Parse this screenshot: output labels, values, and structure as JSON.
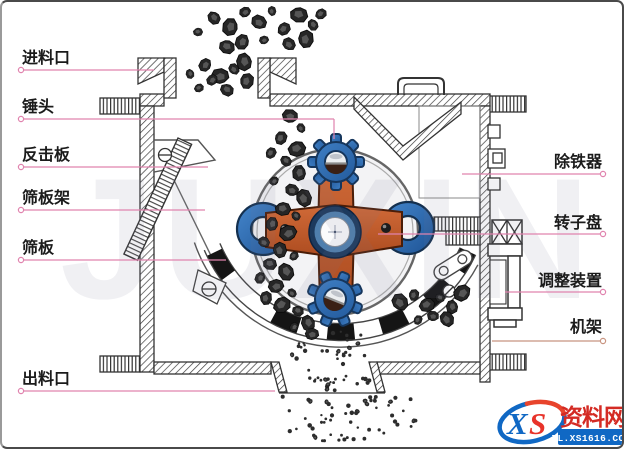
{
  "diagram": {
    "type": "hammer-crusher-structure-diagram",
    "labels_left": [
      {
        "id": "feed-inlet",
        "text": "进料口"
      },
      {
        "id": "hammer-head",
        "text": "锤头"
      },
      {
        "id": "impact-plate",
        "text": "反击板"
      },
      {
        "id": "screen-frame",
        "text": "筛板架"
      },
      {
        "id": "screen-plate",
        "text": "筛板"
      },
      {
        "id": "discharge-outlet",
        "text": "出料口"
      }
    ],
    "labels_right": [
      {
        "id": "iron-remover",
        "text": "除铁器"
      },
      {
        "id": "rotor-disc",
        "text": "转子盘"
      },
      {
        "id": "adjusting-device",
        "text": "调整装置"
      },
      {
        "id": "frame",
        "text": "机架"
      }
    ],
    "colors": {
      "leader_line": "#e083ae",
      "frame_leader_line": "#c89480",
      "rotor_orange": "#c2582a",
      "hammer_blue": "#2f6db5",
      "disc_gray": "#f3f3f5",
      "screen_black": "#151515"
    }
  },
  "watermark": {
    "text": "JUXIN"
  },
  "logo": {
    "monogram": {
      "x": "X",
      "s": "S"
    },
    "site_name": "资料网",
    "domain": "ZL.XS1616.COM",
    "colors": {
      "blue": "#1068c4",
      "red": "#e8332a",
      "name_red": "#d42b24"
    }
  }
}
